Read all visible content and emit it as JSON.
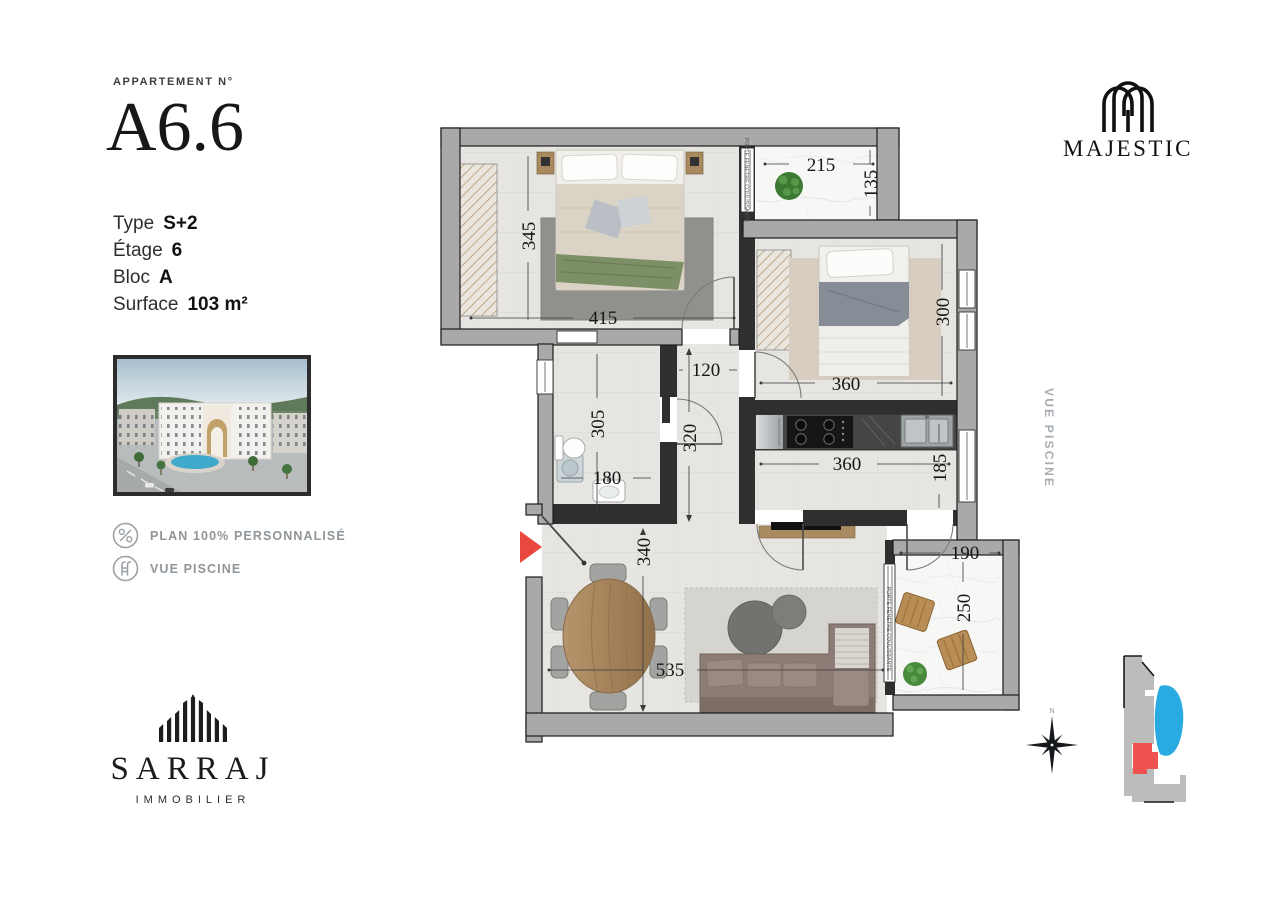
{
  "left_panel": {
    "apartment_label": "APPARTEMENT N°",
    "apartment_number": "A6.6",
    "details": [
      {
        "label": "Type",
        "value": "S+2"
      },
      {
        "label": "Étage",
        "value": "6"
      },
      {
        "label": "Bloc",
        "value": "A"
      },
      {
        "label": "Surface",
        "value": "103 m²"
      }
    ],
    "features": [
      {
        "icon": "percent-icon",
        "label": "PLAN 100% PERSONNALISÉ"
      },
      {
        "icon": "pool-ladder-icon",
        "label": "VUE PISCINE"
      }
    ],
    "brand": {
      "name": "SARRAJ",
      "subtitle": "IMMOBILIER"
    }
  },
  "right_panel": {
    "project_name": "MAJESTIC",
    "side_label": "VUE PISCINE",
    "compass_label": "N"
  },
  "floor_plan": {
    "sliding_door_label": "PORTE FENETRE COULISSANTE",
    "dimensions": {
      "bedroom1_height": "345",
      "bedroom1_width": "415",
      "balcony_top_width": "215",
      "balcony_top_height": "135",
      "bedroom2_height": "300",
      "bedroom2_width": "360",
      "hall_width": "120",
      "hall_height": "320",
      "bathroom_height": "305",
      "bathroom_width": "180",
      "kitchen_width": "360",
      "kitchen_height": "185",
      "living_height": "340",
      "living_width": "535",
      "balcony_bottom_width": "190",
      "balcony_bottom_height": "250"
    },
    "colors": {
      "exterior_wall": "#a9a9a9",
      "wall_outline": "#1c1c1c",
      "interior_wall": "#2f2f2f",
      "floor": "#e6e5e1",
      "balcony_floor": "#f7f7f5",
      "entry_arrow": "#e8483d",
      "pool_blue": "#29abe2",
      "unit_highlight": "#ef5350"
    }
  }
}
